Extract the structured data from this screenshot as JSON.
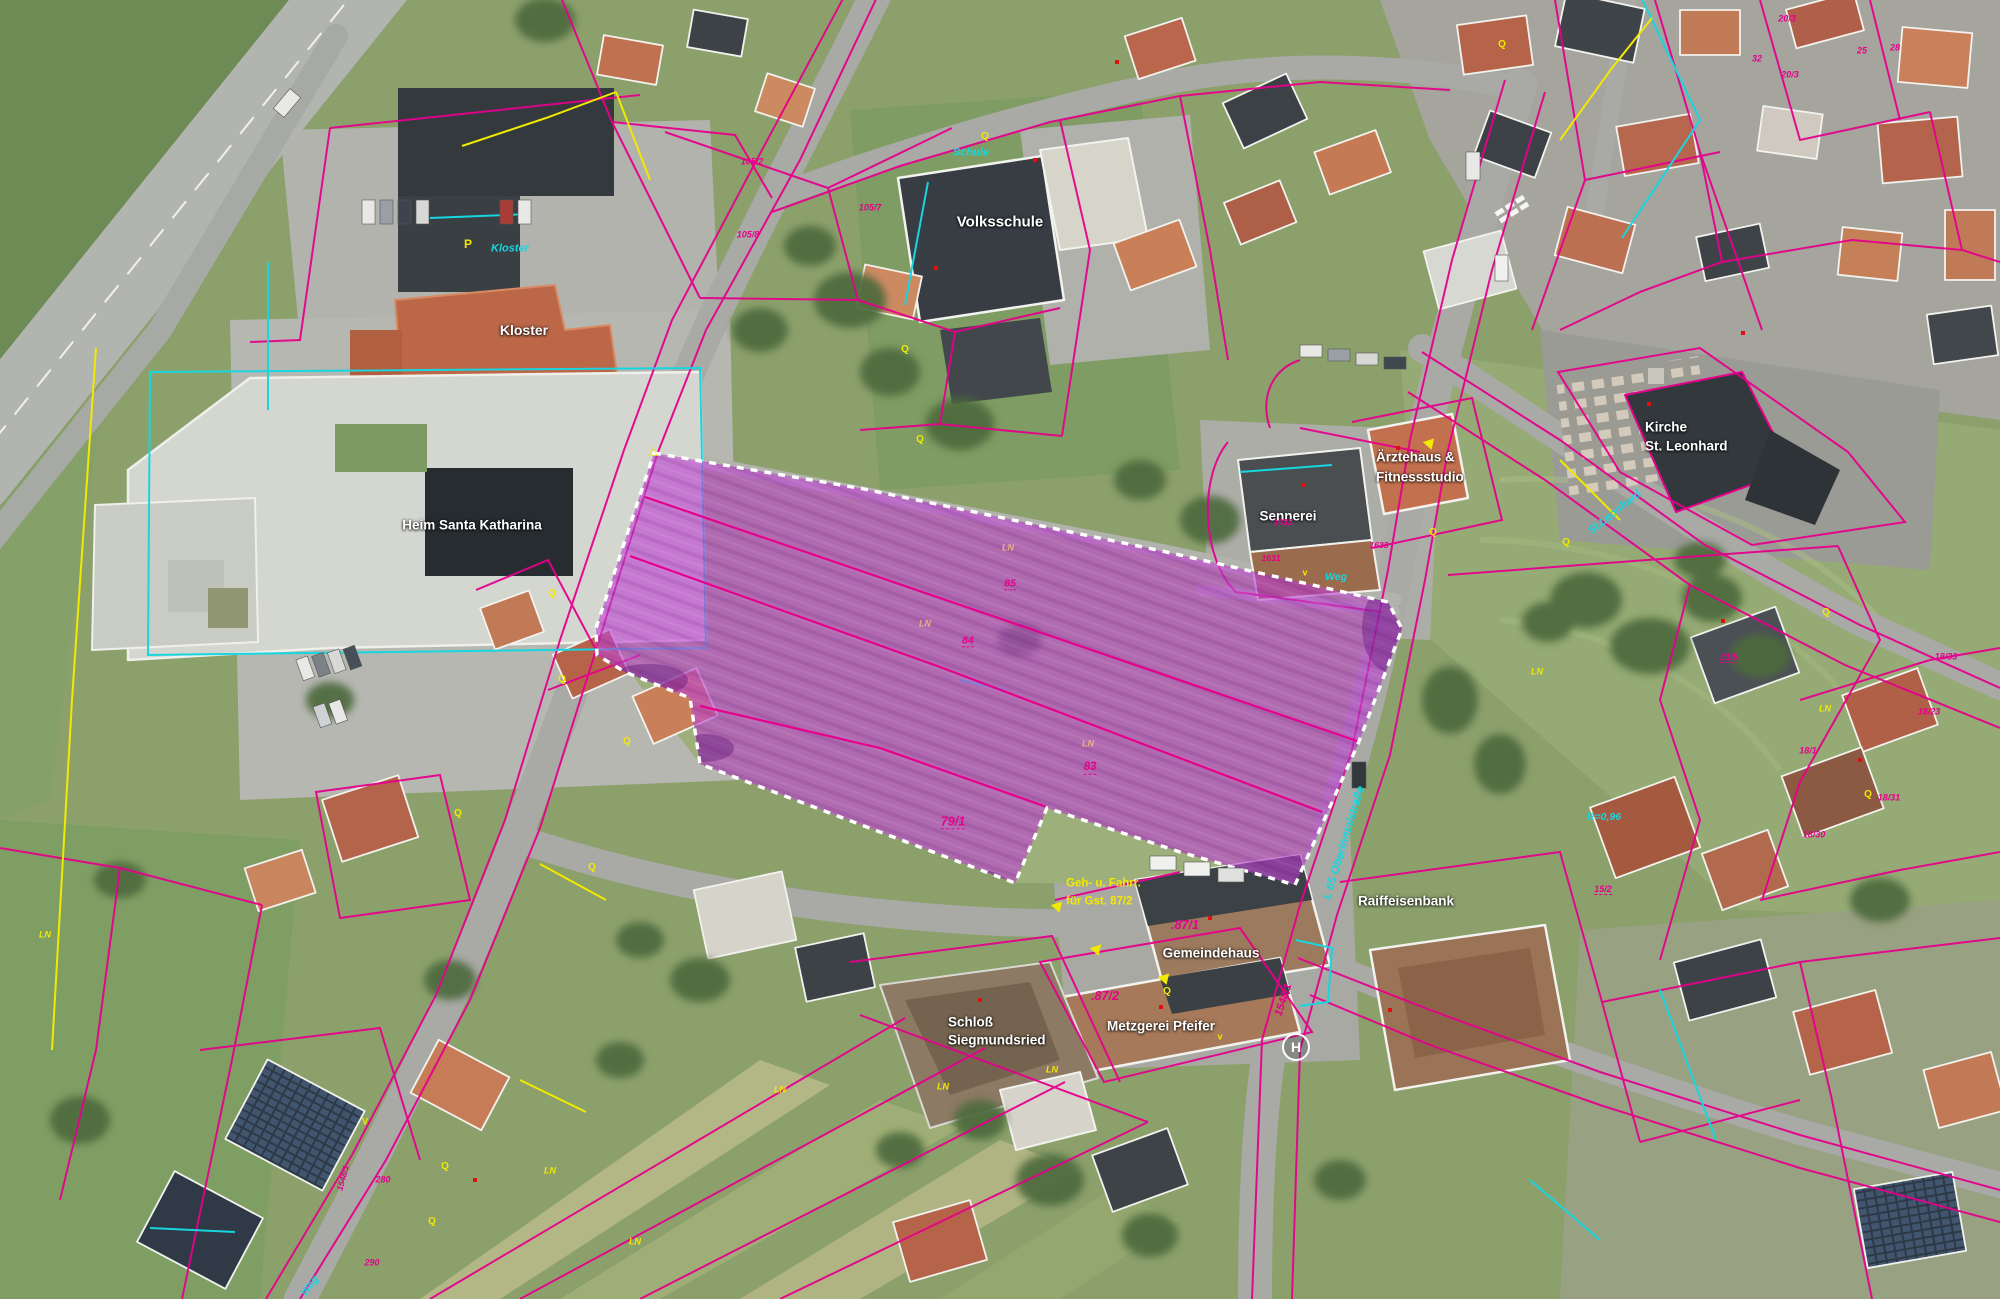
{
  "map": {
    "type": "aerial-cadastral-plan",
    "highlight_color": "#bb3fd0",
    "cadastre_line_color": "#e6008c",
    "utility_cyan": "#17d6e0",
    "utility_yellow": "#f2e900",
    "building_outline_color": "#ffffff"
  },
  "purple_area": {
    "name": "highlighted-parcel-group",
    "fill": "#bb3fd0",
    "border": "#ffffff",
    "points": "654,453 864,489 1162,551 1388,602 1402,629 1358,744 1295,885 1180,852 1047,808 1015,883 700,764 690,698 625,672 597,655 596,628",
    "division_lines": {
      "0": "645,497 940,598 1360,742",
      "1": "630,556 940,667 1322,812",
      "2": "700,706 880,748 1047,807"
    }
  },
  "map_labels": [
    {
      "name": "volksschule-label",
      "text": "Volksschule",
      "x": 1000,
      "y": 222,
      "size": 15,
      "color": "#ffffff",
      "bold": true,
      "shadow": true
    },
    {
      "name": "kloster-label",
      "text": "Kloster",
      "x": 524,
      "y": 330,
      "size": 14,
      "color": "#ffffff",
      "bold": true,
      "shadow": true
    },
    {
      "name": "heim-santa-katharina-label",
      "text": "Heim Santa Katharina",
      "x": 472,
      "y": 525,
      "size": 13.5,
      "color": "#ffffff",
      "bold": true,
      "shadow": true
    },
    {
      "name": "kirche-label-line1",
      "text": "Kirche",
      "x": 1645,
      "y": 427,
      "size": 13.5,
      "color": "#ffffff",
      "bold": true,
      "shadow": true,
      "anchor": "left"
    },
    {
      "name": "kirche-label-line2",
      "text": "St. Leonhard",
      "x": 1645,
      "y": 446,
      "size": 13.5,
      "color": "#ffffff",
      "bold": true,
      "shadow": true,
      "anchor": "left"
    },
    {
      "name": "aerztehaus-label-line1",
      "text": "Ärztehaus &",
      "x": 1376,
      "y": 457,
      "size": 13.5,
      "color": "#ffffff",
      "bold": true,
      "shadow": true,
      "anchor": "left"
    },
    {
      "name": "aerztehaus-label-line2",
      "text": "Fitnessstudio",
      "x": 1376,
      "y": 477,
      "size": 13.5,
      "color": "#ffffff",
      "bold": true,
      "shadow": true,
      "anchor": "left"
    },
    {
      "name": "sennerei-label",
      "text": "Sennerei",
      "x": 1288,
      "y": 516,
      "size": 13.5,
      "color": "#ffffff",
      "bold": true,
      "shadow": true
    },
    {
      "name": "raiffeisenbank-label",
      "text": "Raiffeisenbank",
      "x": 1406,
      "y": 901,
      "size": 13.5,
      "color": "#ffffff",
      "bold": true,
      "shadow": true
    },
    {
      "name": "gemeindehaus-label",
      "text": "Gemeindehaus",
      "x": 1211,
      "y": 953,
      "size": 13.5,
      "color": "#ffffff",
      "bold": true,
      "shadow": true
    },
    {
      "name": "metzgerei-pfeifer-label",
      "text": "Metzgerei Pfeifer",
      "x": 1161,
      "y": 1026,
      "size": 13.5,
      "color": "#ffffff",
      "bold": true,
      "shadow": true
    },
    {
      "name": "schloss-label-line1",
      "text": "Schloß",
      "x": 948,
      "y": 1022,
      "size": 13.5,
      "color": "#ffffff",
      "bold": true,
      "shadow": true,
      "anchor": "left"
    },
    {
      "name": "schloss-label-line2",
      "text": "Siegmundsried",
      "x": 948,
      "y": 1040,
      "size": 13.5,
      "color": "#ffffff",
      "bold": true,
      "shadow": true,
      "anchor": "left"
    },
    {
      "name": "schule-street-label",
      "text": "Schule",
      "x": 971,
      "y": 153,
      "size": 11,
      "color": "#17d6e0",
      "italic": true,
      "bold": true
    },
    {
      "name": "kloster-street-label",
      "text": "Kloster",
      "x": 510,
      "y": 249,
      "size": 11,
      "color": "#17d6e0",
      "italic": true,
      "bold": true
    },
    {
      "name": "st-leonhard-street-label",
      "text": "St.Leonhard",
      "x": 1615,
      "y": 513,
      "size": 11,
      "color": "#17d6e0",
      "italic": true,
      "bold": true,
      "rotate": -38
    },
    {
      "name": "weg-street-label",
      "text": "Weg",
      "x": 1336,
      "y": 577,
      "size": 10.5,
      "color": "#17d6e0",
      "italic": true,
      "bold": true
    },
    {
      "name": "weg-street-label-2",
      "text": "Weg",
      "x": 310,
      "y": 1286,
      "size": 10.5,
      "color": "#17d6e0",
      "italic": true,
      "bold": true,
      "rotate": -52
    },
    {
      "name": "oberinntalstrasse-street-label",
      "text": "L 65  Oberinntalstraße",
      "x": 1345,
      "y": 843,
      "size": 11.5,
      "color": "#17d6e0",
      "italic": true,
      "bold": true,
      "rotate": -73
    },
    {
      "name": "radius-annotation",
      "text": "R=0,96",
      "x": 1604,
      "y": 817,
      "size": 10.5,
      "color": "#17d6e0",
      "italic": true,
      "bold": true
    },
    {
      "name": "parking-label",
      "text": "P",
      "x": 468,
      "y": 244,
      "size": 12,
      "color": "#f2e900",
      "bold": true
    },
    {
      "name": "geh-fahrr-annotation-line1",
      "text": "Geh- u. Fahrr.",
      "x": 1066,
      "y": 884,
      "size": 11.5,
      "color": "#f2e900",
      "bold": true,
      "anchor": "left"
    },
    {
      "name": "geh-fahrr-annotation-line2",
      "text": "für Gst. 87/2",
      "x": 1066,
      "y": 902,
      "size": 11.5,
      "color": "#f2e900",
      "bold": true,
      "anchor": "left"
    },
    {
      "name": "ln-label",
      "text": "LN",
      "x": 1008,
      "y": 548,
      "size": 9,
      "color": "#e9b083",
      "bold": true,
      "italic": true
    },
    {
      "name": "ln-label",
      "text": "LN",
      "x": 925,
      "y": 624,
      "size": 9,
      "color": "#e9b083",
      "bold": true,
      "italic": true
    },
    {
      "name": "ln-label",
      "text": "LN",
      "x": 1088,
      "y": 744,
      "size": 9,
      "color": "#e9b083",
      "bold": true,
      "italic": true
    },
    {
      "name": "ln-label",
      "text": "LN",
      "x": 1537,
      "y": 672,
      "size": 9,
      "color": "#f2e900",
      "bold": true,
      "italic": true
    },
    {
      "name": "ln-label",
      "text": "LN",
      "x": 1825,
      "y": 709,
      "size": 9,
      "color": "#f2e900",
      "bold": true,
      "italic": true
    },
    {
      "name": "ln-label",
      "text": "LN",
      "x": 45,
      "y": 935,
      "size": 9,
      "color": "#f2e900",
      "bold": true,
      "italic": true
    },
    {
      "name": "ln-label",
      "text": "LN",
      "x": 550,
      "y": 1171,
      "size": 9,
      "color": "#f2e900",
      "bold": true,
      "italic": true
    },
    {
      "name": "ln-label",
      "text": "LN",
      "x": 635,
      "y": 1242,
      "size": 9,
      "color": "#f2e900",
      "bold": true,
      "italic": true
    },
    {
      "name": "ln-label",
      "text": "LN",
      "x": 943,
      "y": 1087,
      "size": 9,
      "color": "#f2e900",
      "bold": true,
      "italic": true
    },
    {
      "name": "ln-label",
      "text": "LN",
      "x": 1052,
      "y": 1070,
      "size": 9,
      "color": "#f2e900",
      "bold": true,
      "italic": true
    },
    {
      "name": "ln-label",
      "text": "LN",
      "x": 780,
      "y": 1090,
      "size": 9,
      "color": "#f2e900",
      "bold": true,
      "italic": true
    },
    {
      "name": "v-marker",
      "text": "V",
      "x": 365,
      "y": 1122,
      "size": 9,
      "color": "#f2e900",
      "bold": true
    },
    {
      "name": "v-marker",
      "text": "v",
      "x": 1305,
      "y": 573,
      "size": 9,
      "color": "#f2e900",
      "bold": true
    },
    {
      "name": "v-marker",
      "text": "v",
      "x": 1220,
      "y": 1037,
      "size": 9,
      "color": "#f2e900",
      "bold": true
    },
    {
      "name": "q-symbol",
      "text": "Q",
      "x": 985,
      "y": 137,
      "size": 10,
      "color": "#f2e900",
      "bold": true
    },
    {
      "name": "q-symbol",
      "text": "Q",
      "x": 905,
      "y": 350,
      "size": 10,
      "color": "#f2e900",
      "bold": true
    },
    {
      "name": "q-symbol",
      "text": "Q",
      "x": 1502,
      "y": 45,
      "size": 10,
      "color": "#f2e900",
      "bold": true
    },
    {
      "name": "q-symbol",
      "text": "Q",
      "x": 920,
      "y": 440,
      "size": 10,
      "color": "#f2e900",
      "bold": true
    },
    {
      "name": "q-symbol",
      "text": "Q",
      "x": 552,
      "y": 594,
      "size": 10,
      "color": "#f2e900",
      "bold": true
    },
    {
      "name": "q-symbol",
      "text": "Q",
      "x": 562,
      "y": 680,
      "size": 10,
      "color": "#f2e900",
      "bold": true
    },
    {
      "name": "q-symbol",
      "text": "Q",
      "x": 627,
      "y": 742,
      "size": 10,
      "color": "#f2e900",
      "bold": true
    },
    {
      "name": "q-symbol",
      "text": "Q",
      "x": 458,
      "y": 814,
      "size": 10,
      "color": "#f2e900",
      "bold": true
    },
    {
      "name": "q-symbol",
      "text": "Q",
      "x": 592,
      "y": 868,
      "size": 10,
      "color": "#f2e900",
      "bold": true
    },
    {
      "name": "q-symbol",
      "text": "Q",
      "x": 1167,
      "y": 992,
      "size": 10,
      "color": "#f2e900",
      "bold": true
    },
    {
      "name": "q-symbol",
      "text": "Q",
      "x": 1433,
      "y": 533,
      "size": 10,
      "color": "#f2e900",
      "bold": true
    },
    {
      "name": "q-symbol",
      "text": "Q",
      "x": 1566,
      "y": 543,
      "size": 10,
      "color": "#f2e900",
      "bold": true
    },
    {
      "name": "q-symbol",
      "text": "Q",
      "x": 1826,
      "y": 613,
      "size": 10,
      "color": "#f2e900",
      "bold": true
    },
    {
      "name": "q-symbol",
      "text": "Q",
      "x": 1868,
      "y": 795,
      "size": 10,
      "color": "#f2e900",
      "bold": true
    },
    {
      "name": "q-symbol",
      "text": "Q",
      "x": 445,
      "y": 1167,
      "size": 10,
      "color": "#f2e900",
      "bold": true
    },
    {
      "name": "q-symbol",
      "text": "Q",
      "x": 432,
      "y": 1222,
      "size": 10,
      "color": "#f2e900",
      "bold": true
    },
    {
      "name": "parcel-number",
      "text": ".87/1",
      "x": 1185,
      "y": 925,
      "size": 12.5,
      "color": "#e6008c",
      "bold": true,
      "italic": true
    },
    {
      "name": "parcel-number",
      "text": ".87/2",
      "x": 1105,
      "y": 996,
      "size": 12.5,
      "color": "#e6008c",
      "bold": true,
      "italic": true
    },
    {
      "name": "parcel-number",
      "text": "1548/1",
      "x": 1284,
      "y": 1000,
      "size": 11,
      "color": "#e6008c",
      "bold": true,
      "italic": true,
      "rotate": -72
    },
    {
      "name": "parcel-number",
      "text": "85",
      "x": 1010,
      "y": 584,
      "size": 10.5,
      "color": "#e6008c",
      "bold": true,
      "italic": true,
      "underline": true
    },
    {
      "name": "parcel-number",
      "text": "84",
      "x": 968,
      "y": 641,
      "size": 10.5,
      "color": "#e6008c",
      "bold": true,
      "italic": true,
      "underline": true
    },
    {
      "name": "parcel-number",
      "text": "83",
      "x": 1090,
      "y": 768,
      "size": 11.5,
      "color": "#e6008c",
      "bold": true,
      "italic": true,
      "underline": true
    },
    {
      "name": "parcel-number",
      "text": "79/1",
      "x": 953,
      "y": 822,
      "size": 12.5,
      "color": "#e6008c",
      "bold": true,
      "italic": true,
      "underline": true
    },
    {
      "name": "parcel-number",
      "text": "1633",
      "x": 1379,
      "y": 545,
      "size": 8.5,
      "color": "#e6008c",
      "bold": true,
      "italic": true
    },
    {
      "name": "parcel-number",
      "text": "1631",
      "x": 1271,
      "y": 558,
      "size": 8.5,
      "color": "#e6008c",
      "bold": true,
      "italic": true
    },
    {
      "name": "parcel-number",
      "text": "1632",
      "x": 1283,
      "y": 522,
      "size": 8.5,
      "color": "#e6008c",
      "bold": true,
      "italic": true
    },
    {
      "name": "parcel-number",
      "text": "105/2",
      "x": 752,
      "y": 162,
      "size": 9,
      "color": "#e6008c",
      "bold": true,
      "italic": true
    },
    {
      "name": "parcel-number",
      "text": "105/8",
      "x": 748,
      "y": 235,
      "size": 9,
      "color": "#e6008c",
      "bold": true,
      "italic": true
    },
    {
      "name": "parcel-number",
      "text": "105/7",
      "x": 870,
      "y": 208,
      "size": 9,
      "color": "#e6008c",
      "bold": true,
      "italic": true
    },
    {
      "name": "parcel-number",
      "text": "20/3",
      "x": 1787,
      "y": 19,
      "size": 9,
      "color": "#e6008c",
      "bold": true,
      "italic": true
    },
    {
      "name": "parcel-number",
      "text": "32",
      "x": 1757,
      "y": 59,
      "size": 9,
      "color": "#e6008c",
      "bold": true,
      "italic": true
    },
    {
      "name": "parcel-number",
      "text": "25",
      "x": 1862,
      "y": 51,
      "size": 9,
      "color": "#e6008c",
      "bold": true,
      "italic": true
    },
    {
      "name": "parcel-number",
      "text": "28",
      "x": 1895,
      "y": 48,
      "size": 9,
      "color": "#e6008c",
      "bold": true,
      "italic": true
    },
    {
      "name": "parcel-number",
      "text": "20/3",
      "x": 1790,
      "y": 75,
      "size": 9,
      "color": "#e6008c",
      "bold": true,
      "italic": true
    },
    {
      "name": "parcel-number",
      "text": "21/6",
      "x": 1729,
      "y": 658,
      "size": 9,
      "color": "#e6008c",
      "bold": true,
      "italic": true,
      "underline": true
    },
    {
      "name": "parcel-number",
      "text": "18/33",
      "x": 1946,
      "y": 657,
      "size": 9,
      "color": "#e6008c",
      "bold": true,
      "italic": true
    },
    {
      "name": "parcel-number",
      "text": "18/23",
      "x": 1929,
      "y": 712,
      "size": 9,
      "color": "#e6008c",
      "bold": true,
      "italic": true
    },
    {
      "name": "parcel-number",
      "text": "18/31",
      "x": 1889,
      "y": 798,
      "size": 9,
      "color": "#e6008c",
      "bold": true,
      "italic": true
    },
    {
      "name": "parcel-number",
      "text": "18/30",
      "x": 1814,
      "y": 835,
      "size": 9,
      "color": "#e6008c",
      "bold": true,
      "italic": true
    },
    {
      "name": "parcel-number",
      "text": "18/1",
      "x": 1808,
      "y": 751,
      "size": 9,
      "color": "#e6008c",
      "bold": true,
      "italic": true
    },
    {
      "name": "parcel-number",
      "text": "15/2",
      "x": 1603,
      "y": 890,
      "size": 9,
      "color": "#e6008c",
      "bold": true,
      "italic": true,
      "underline": true
    },
    {
      "name": "parcel-number",
      "text": "280",
      "x": 383,
      "y": 1180,
      "size": 9,
      "color": "#e6008c",
      "bold": true,
      "italic": true
    },
    {
      "name": "parcel-number",
      "text": "290",
      "x": 372,
      "y": 1263,
      "size": 9,
      "color": "#e6008c",
      "bold": true,
      "italic": true
    },
    {
      "name": "parcel-number",
      "text": "1548/1",
      "x": 343,
      "y": 1178,
      "size": 8.5,
      "color": "#e6008c",
      "bold": true,
      "italic": true,
      "rotate": -75
    }
  ],
  "icons": {
    "bus_stop": {
      "name": "bus-stop-icon",
      "glyph": "H",
      "x": 1296,
      "y": 1047
    },
    "corner_triangle": {
      "name": "triangle-marker-icon",
      "glyph": "△",
      "x": 653,
      "y": 451
    },
    "arrow_triangles": [
      {
        "x": 1058,
        "y": 908
      },
      {
        "x": 1097,
        "y": 951
      },
      {
        "x": 1165,
        "y": 980
      },
      {
        "x": 1430,
        "y": 445
      }
    ],
    "survey_points": [
      {
        "x": 936,
        "y": 268
      },
      {
        "x": 1035,
        "y": 160
      },
      {
        "x": 1398,
        "y": 448
      },
      {
        "x": 1304,
        "y": 485
      },
      {
        "x": 1649,
        "y": 404
      },
      {
        "x": 1210,
        "y": 918
      },
      {
        "x": 1161,
        "y": 1007
      },
      {
        "x": 980,
        "y": 1000
      },
      {
        "x": 1723,
        "y": 621
      },
      {
        "x": 1860,
        "y": 760
      },
      {
        "x": 1390,
        "y": 1010
      },
      {
        "x": 475,
        "y": 1180
      },
      {
        "x": 1117,
        "y": 62
      },
      {
        "x": 1743,
        "y": 333
      }
    ]
  }
}
